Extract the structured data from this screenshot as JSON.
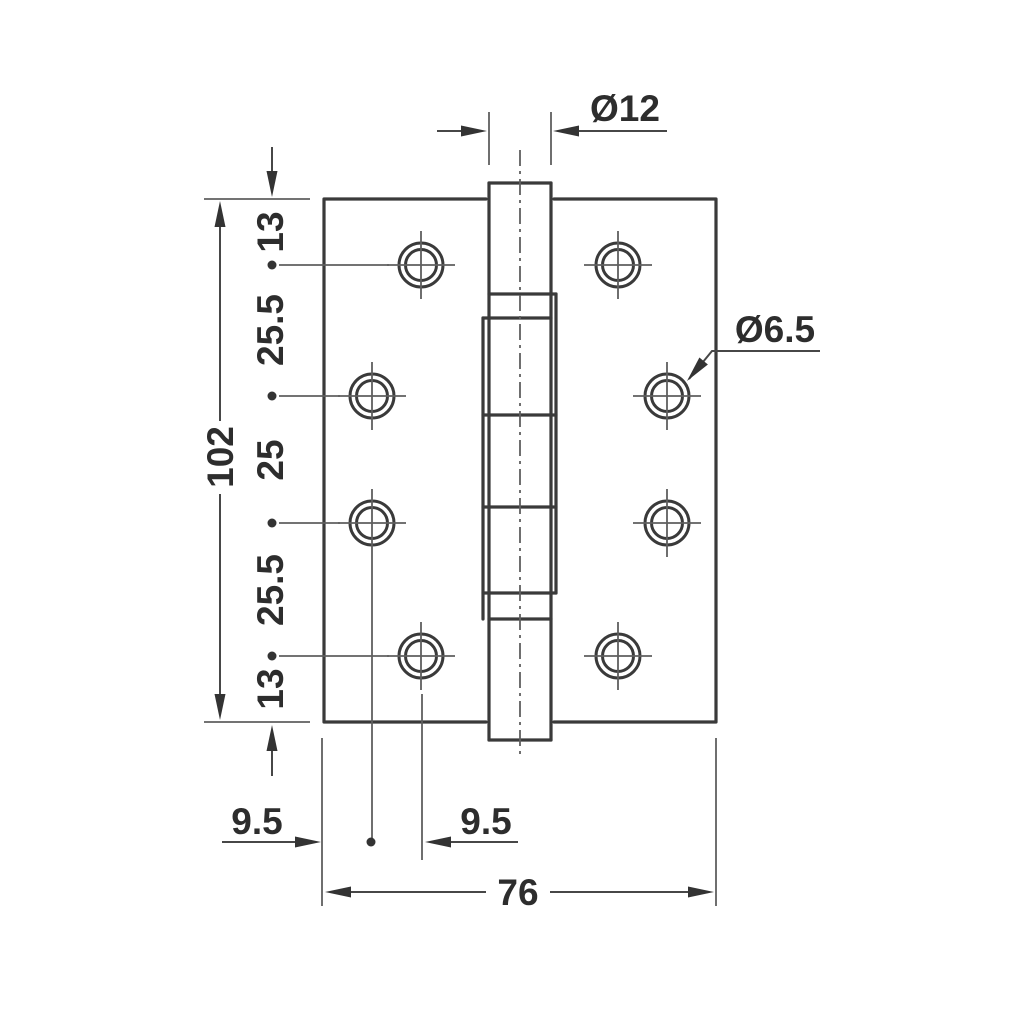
{
  "drawing": {
    "type": "technical-drawing",
    "subject": "butt hinge front elevation",
    "colors": {
      "background": "#ffffff",
      "outline": "#3a3a3a",
      "thin_line": "#5f5f5f",
      "text": "#2d2d2d"
    },
    "dims": {
      "pin_diameter": "Ø12",
      "screw_hole_diameter": "Ø6.5",
      "overall_height": "102",
      "spacing_top": "13",
      "spacing_upper": "25.5",
      "spacing_middle": "25",
      "spacing_lower": "25.5",
      "spacing_bottom": "13",
      "edge_offset_left": "9.5",
      "hole_offset": "9.5",
      "overall_width": "76"
    }
  }
}
